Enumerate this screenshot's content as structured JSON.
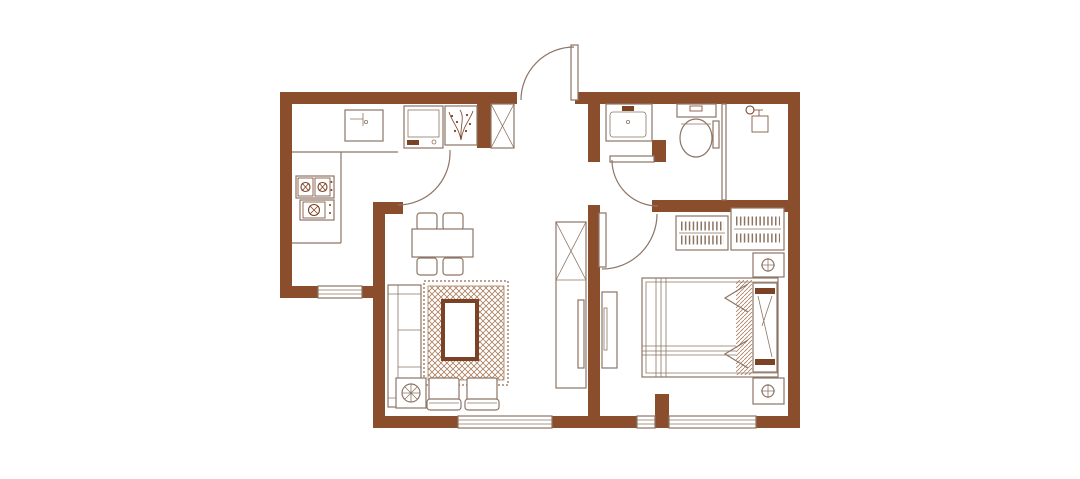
{
  "title": "Two-room apartment floor plan",
  "colors": {
    "wall": "#8B4E2C",
    "line": "#8d7565",
    "accent": "#7b4226",
    "pattern": "#a97f5f",
    "bg": "#ffffff"
  },
  "rooms": [
    {
      "id": "kitchen",
      "fixtures": [
        "kitchen-sink",
        "gas-stove-two-burner",
        "gas-stove-single-burner",
        "counter",
        "kitchen-window",
        "kitchen-door"
      ]
    },
    {
      "id": "entry-hall",
      "fixtures": [
        "entry-door",
        "washing-machine",
        "plant-box",
        "shoe-cabinet"
      ]
    },
    {
      "id": "bathroom",
      "fixtures": [
        "bathroom-vanity",
        "toilet",
        "shower-head",
        "shower-partition",
        "bathroom-door"
      ]
    },
    {
      "id": "living-dining",
      "fixtures": [
        "dining-table",
        "dining-chairs",
        "sofa",
        "area-rug",
        "armchairs",
        "floor-plant",
        "tv-cabinet-living",
        "living-window"
      ]
    },
    {
      "id": "bedroom",
      "fixtures": [
        "bedroom-door",
        "wardrobe-left",
        "wardrobe-right",
        "nightstand-lamp-top",
        "nightstand-lamp-bottom",
        "double-bed",
        "pillows",
        "headboard",
        "tv-console-bedroom",
        "bedroom-window"
      ]
    }
  ],
  "legend": {
    "door-symbol": "quarter-circle swing arc",
    "window-symbol": "triple parallel lines in wall",
    "lamp-symbol": "circle with cross",
    "wardrobe-symbol": "hanger comb with rail"
  }
}
